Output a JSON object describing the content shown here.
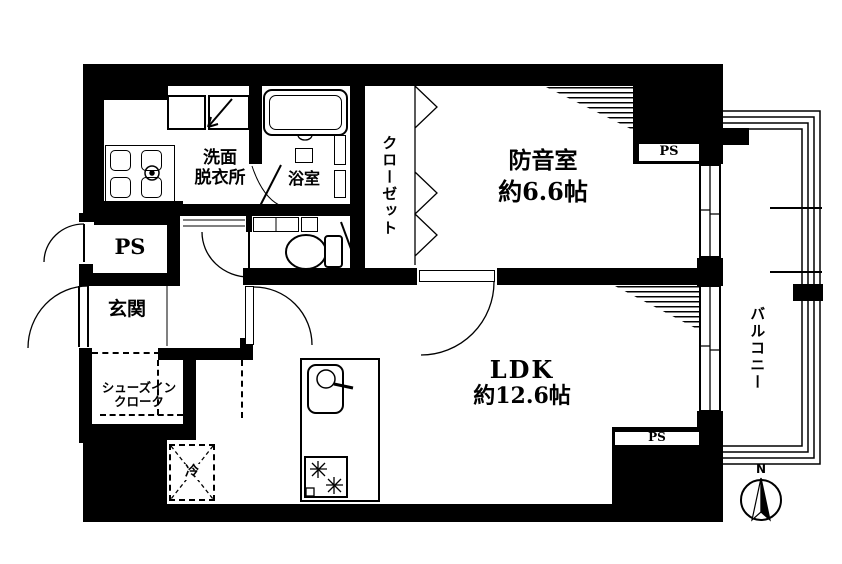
{
  "plan": {
    "rooms": {
      "soundproof_room": {
        "label": "防音室",
        "size": "約6.6帖"
      },
      "ldk": {
        "label": "LDK",
        "size": "約12.6帖"
      },
      "closet": {
        "label": "クローゼット"
      },
      "washroom": {
        "label_line1": "洗面",
        "label_line2": "脱衣所"
      },
      "bathroom": {
        "label": "浴室"
      },
      "entrance": {
        "label": "玄関"
      },
      "shoe_closet": {
        "label_line1": "シューズイン",
        "label_line2": "クローク"
      },
      "balcony": {
        "label": "バルコニー"
      }
    },
    "pipe_spaces": {
      "left": "PS",
      "top_right": "PS",
      "bottom_right": "PS"
    },
    "appliances": {
      "refrigerator": "冷"
    },
    "compass": {
      "north": "N"
    },
    "colors": {
      "line": "#000000",
      "background": "#ffffff"
    }
  }
}
